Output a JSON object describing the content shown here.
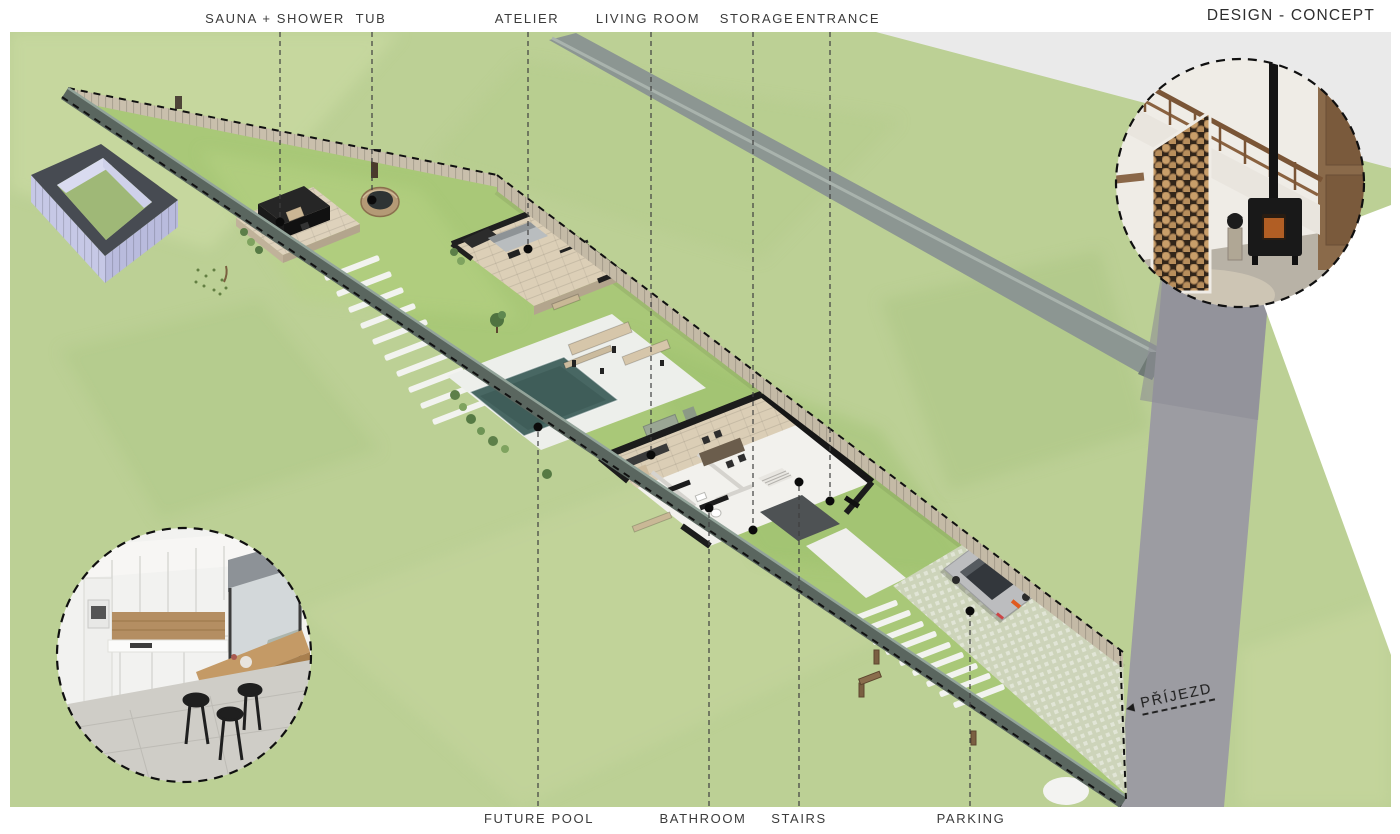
{
  "title": "DESIGN - CONCEPT",
  "top_labels": [
    {
      "label": "SAUNA + SHOWER"
    },
    {
      "label": "TUB"
    },
    {
      "label": "ATELIER"
    },
    {
      "label": "LIVING ROOM"
    },
    {
      "label": "STORAGE"
    },
    {
      "label": "ENTRANCE"
    }
  ],
  "bottom_labels": [
    {
      "label": "FUTURE POOL"
    },
    {
      "label": "BATHROOM"
    },
    {
      "label": "STAIRS"
    },
    {
      "label": "PARKING"
    }
  ],
  "road_label": {
    "arrow": "◀",
    "text": "PŘÍJEZD"
  },
  "colors": {
    "grass_outside": "#bcd095",
    "grass_plot": "#a9c878",
    "road": "#9b9ba1",
    "footpath": "#eaeaea",
    "retaining_wall": "#8c9692",
    "fence_wood": "#c9bfac",
    "boundary_wall": "#5a665f",
    "pool_water": "#44615d",
    "purple_structure": "#c6c8e6",
    "car": "#bcbdbf",
    "label_text": "#3b3b3b"
  }
}
